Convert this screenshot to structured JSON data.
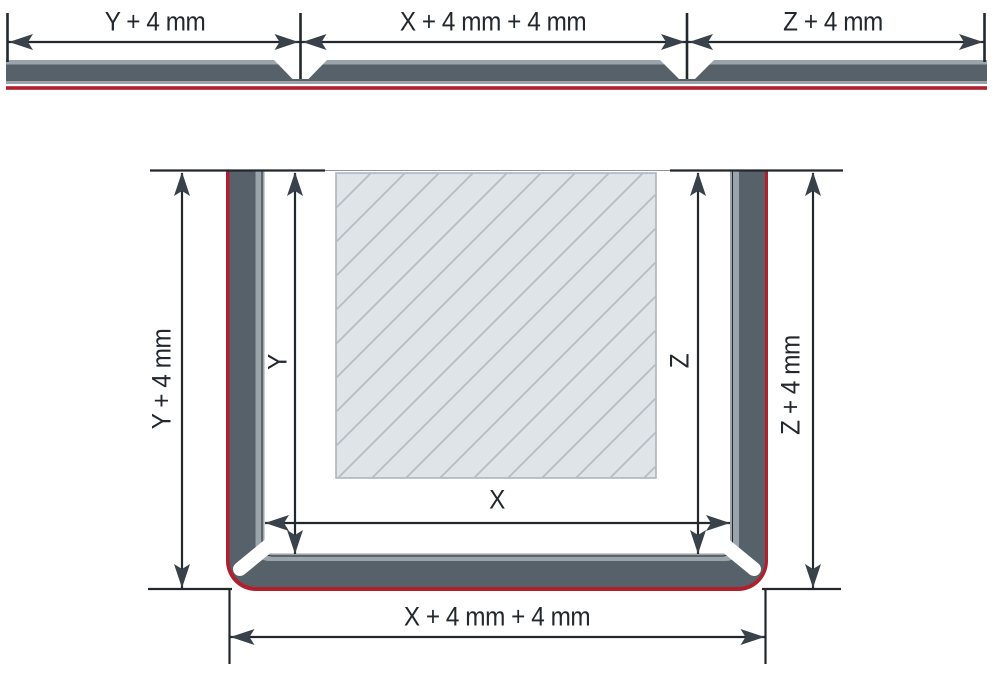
{
  "top_diagram": {
    "segments": [
      {
        "label": "Y + 4 mm"
      },
      {
        "label": "X + 4 mm + 4 mm"
      },
      {
        "label": "Z + 4 mm"
      }
    ]
  },
  "bottom_diagram": {
    "dims": {
      "left_outer": "Y + 4 mm",
      "left_inner": "Y",
      "right_inner": "Z",
      "right_outer": "Z + 4 mm",
      "inner_width": "X",
      "outer_width": "X + 4 mm + 4 mm"
    }
  },
  "colors": {
    "profile_dark": "#57616a",
    "profile_liner": "#9ba3ab",
    "adhesive_red": "#b11f2d",
    "panel_fill": "#dfe4e9",
    "panel_hatch": "#b4bcc4",
    "panel_border": "#a9b1b9",
    "line_color": "#22282d",
    "arrow_color": "#39424a"
  }
}
